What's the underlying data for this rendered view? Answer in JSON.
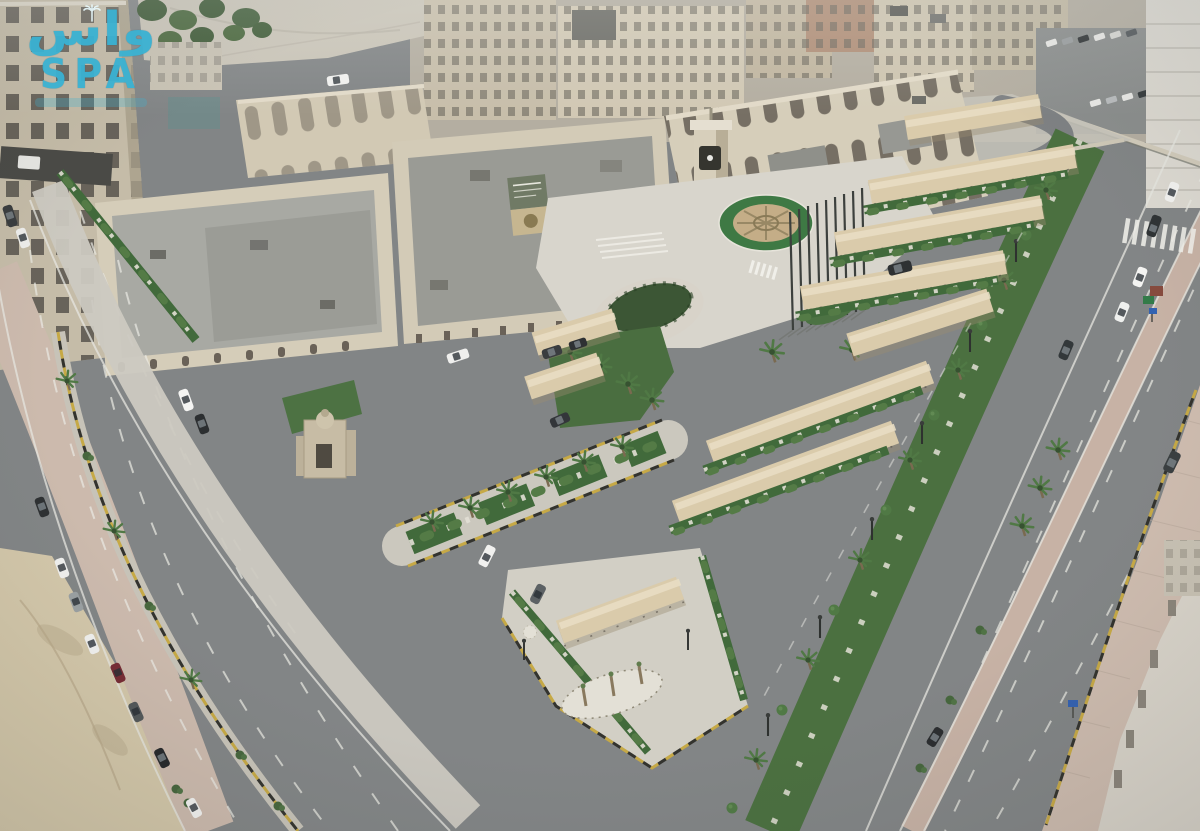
{
  "meta": {
    "type": "aerial-photograph",
    "description": "Overcast aerial drone view of a beige municipal government complex with a clock tower, circular emblem roundabout, a row of flag poles, long diagonal rows of tan car-park shade canopies, palm-lined landscaped medians, a wide multi-lane boulevard with light traffic, parked cars along a side street and a sandy lot in the lower-left corner, dense city blocks along the horizon."
  },
  "watermark": {
    "arabic": "واس",
    "latin": "SPA",
    "color": "#3ab2d3"
  },
  "palette": {
    "asphalt": "#828586",
    "building_beige": "#d5ccb6",
    "roof_gray": "#a0a19c",
    "canopy_tan": "#dbcba8",
    "grass_green": "#3f6b38",
    "palm_green": "#4e7a42",
    "sand": "#d4c7a7",
    "sidewalk_pink": "#cdbaac",
    "median_pink": "#c8b2a4",
    "curb_yellow": "#c9a93d",
    "roundabout_ring": "#3a7a41",
    "roundabout_center": "#c6ad84"
  },
  "scene": {
    "flag_poles": 9,
    "canopy_rows": 10,
    "parked_cars_left_street": 10,
    "vehicles_on_boulevard": 7,
    "crosswalk_stripes": 8,
    "clock_tower": 1,
    "roundabout": 1
  }
}
